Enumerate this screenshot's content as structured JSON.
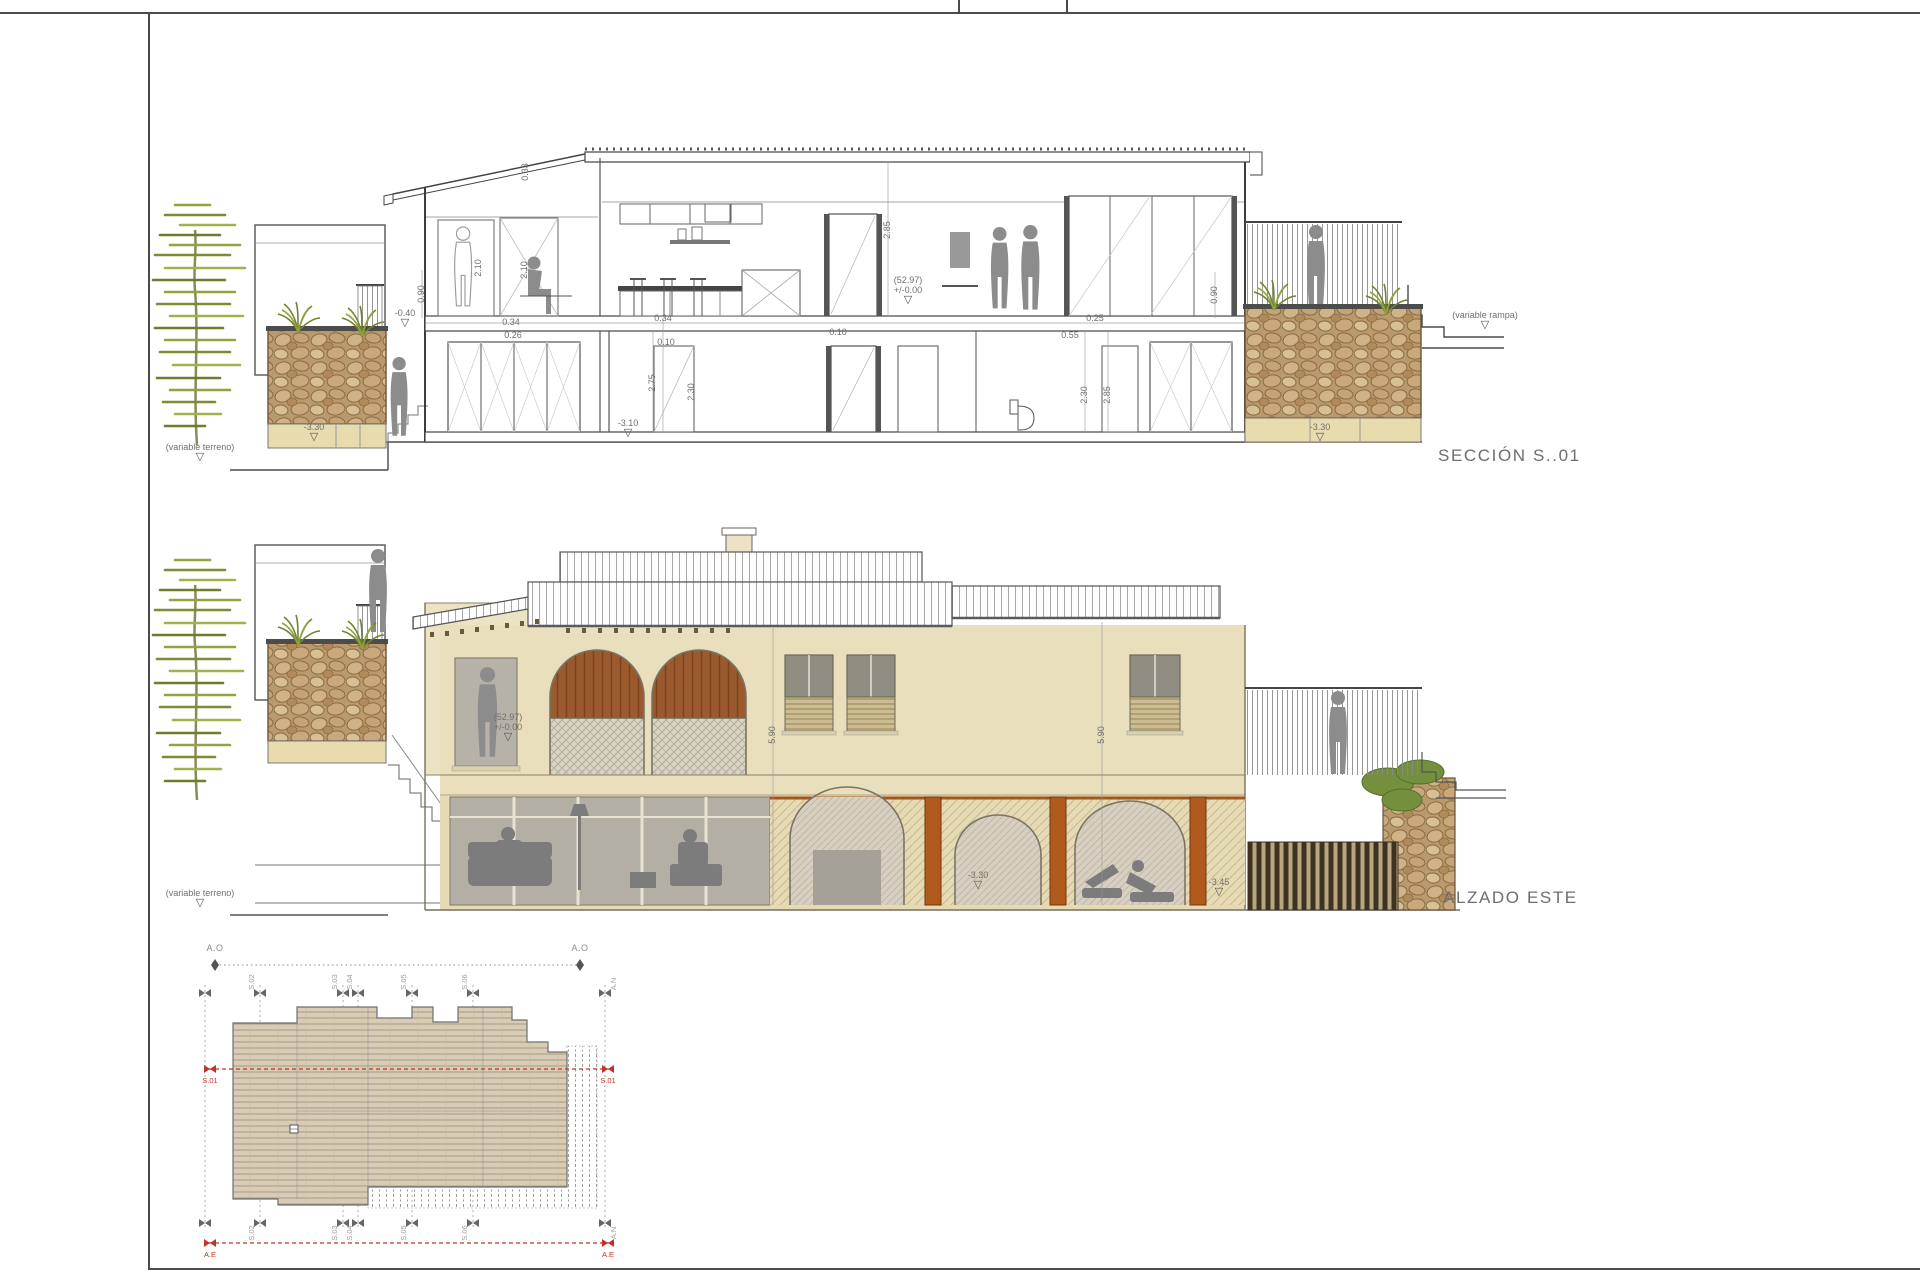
{
  "sheet": {
    "type": "architectural-drawing-sheet",
    "colors": {
      "accent_red": "#c23327",
      "stone": "#b89a6c",
      "wall_beige": "#e9dfbc",
      "wood_orange": "#b05a1e",
      "olive_tree": "#8fa03c",
      "line": "#4a4a4a"
    }
  },
  "section": {
    "title": "SECCIÓN S..01",
    "labels": [
      {
        "type": "level",
        "lines": [
          "-0.40"
        ],
        "x": 275,
        "y": 238,
        "name": "level-minus-0-40"
      },
      {
        "type": "dim",
        "text": "0.34",
        "x": 381,
        "y": 243,
        "name": "dim-0-34"
      },
      {
        "type": "dim",
        "text": "0.26",
        "x": 383,
        "y": 256,
        "name": "dim-0-26"
      },
      {
        "type": "dim",
        "text": "0.34",
        "x": 533,
        "y": 239,
        "name": "dim-0-34"
      },
      {
        "type": "dim",
        "text": "0.10",
        "x": 536,
        "y": 263,
        "name": "dim-0-10"
      },
      {
        "type": "dim",
        "text": "0.10",
        "x": 708,
        "y": 253,
        "name": "dim-0-10"
      },
      {
        "type": "dim",
        "text": "0.25",
        "x": 965,
        "y": 239,
        "name": "dim-0-25"
      },
      {
        "type": "dim",
        "text": "0.55",
        "x": 940,
        "y": 256,
        "name": "dim-0-55"
      },
      {
        "type": "rdim",
        "text": "0.90",
        "x": 292,
        "y": 214,
        "name": "dim-0-90"
      },
      {
        "type": "rdim",
        "text": "2.10",
        "x": 349,
        "y": 188,
        "name": "dim-2-10"
      },
      {
        "type": "rdim",
        "text": "2.10",
        "x": 395,
        "y": 190,
        "name": "dim-2-10"
      },
      {
        "type": "rdim",
        "text": "0.33",
        "x": 396,
        "y": 92,
        "name": "dim-0-33"
      },
      {
        "type": "rdim",
        "text": "2.75",
        "x": 523,
        "y": 303,
        "name": "dim-2-75"
      },
      {
        "type": "rdim",
        "text": "2.30",
        "x": 562,
        "y": 312,
        "name": "dim-2-30"
      },
      {
        "type": "rdim",
        "text": "2.85",
        "x": 758,
        "y": 150,
        "name": "dim-2-85"
      },
      {
        "type": "rdim",
        "text": "2.30",
        "x": 955,
        "y": 315,
        "name": "dim-2-30"
      },
      {
        "type": "rdim",
        "text": "2.85",
        "x": 978,
        "y": 315,
        "name": "dim-2-85"
      },
      {
        "type": "rdim",
        "text": "0.90",
        "x": 1085,
        "y": 215,
        "name": "dim-0-90"
      },
      {
        "type": "level",
        "lines": [
          "-3.30"
        ],
        "x": 184,
        "y": 352,
        "name": "level-minus-3-30"
      },
      {
        "type": "level",
        "lines": [
          "(variable terreno)"
        ],
        "x": 70,
        "y": 372,
        "name": "level-variable-terreno"
      },
      {
        "type": "level",
        "lines": [
          "-3.10"
        ],
        "x": 498,
        "y": 348,
        "name": "level-minus-3-10"
      },
      {
        "type": "level",
        "lines": [
          "(52.97)",
          "+/-0.00"
        ],
        "x": 778,
        "y": 210,
        "name": "level-zero"
      },
      {
        "type": "level",
        "lines": [
          "-3.30"
        ],
        "x": 1190,
        "y": 352,
        "name": "level-minus-3-30"
      },
      {
        "type": "level",
        "lines": [
          "(variable rampa)"
        ],
        "x": 1355,
        "y": 240,
        "name": "level-variable-rampa"
      }
    ]
  },
  "elevation": {
    "title": "ALZADO ESTE",
    "labels": [
      {
        "type": "level",
        "lines": [
          "(52.97)",
          "+/-0.00"
        ],
        "x": 378,
        "y": 207,
        "name": "level-zero"
      },
      {
        "type": "level",
        "lines": [
          "-3.30"
        ],
        "x": 848,
        "y": 360,
        "name": "level-minus-3-30"
      },
      {
        "type": "level",
        "lines": [
          "-3.45"
        ],
        "x": 1089,
        "y": 367,
        "name": "level-minus-3-45"
      },
      {
        "type": "level",
        "lines": [
          "(variable terreno)"
        ],
        "x": 70,
        "y": 378,
        "name": "level-variable-terreno"
      },
      {
        "type": "rdim",
        "text": "5.90",
        "x": 643,
        "y": 215,
        "name": "dim-5-90"
      },
      {
        "type": "rdim",
        "text": "5.90",
        "x": 972,
        "y": 215,
        "name": "dim-5-90"
      }
    ]
  },
  "plan": {
    "labels": [
      {
        "type": "plain",
        "text": "A.O",
        "x": 35,
        "y": 14,
        "name": "elevation-mark-ao"
      },
      {
        "type": "plain",
        "text": "A.O",
        "x": 400,
        "y": 14,
        "name": "elevation-mark-ao"
      },
      {
        "type": "rplan",
        "text": "S.02",
        "x": 72,
        "y": 47,
        "name": "section-mark-s02"
      },
      {
        "type": "rplan",
        "text": "S.03",
        "x": 155,
        "y": 47,
        "name": "section-mark-s03"
      },
      {
        "type": "rplan",
        "text": "S.04",
        "x": 170,
        "y": 47,
        "name": "section-mark-s04"
      },
      {
        "type": "rplan",
        "text": "S.05",
        "x": 224,
        "y": 47,
        "name": "section-mark-s05"
      },
      {
        "type": "rplan",
        "text": "S.06",
        "x": 285,
        "y": 47,
        "name": "section-mark-s06"
      },
      {
        "type": "rplan",
        "text": "A.N",
        "x": 434,
        "y": 49,
        "name": "elevation-mark-an"
      },
      {
        "type": "rplan",
        "text": "S.02",
        "x": 72,
        "y": 298,
        "name": "section-mark-s02"
      },
      {
        "type": "rplan",
        "text": "S.03",
        "x": 155,
        "y": 298,
        "name": "section-mark-s03"
      },
      {
        "type": "rplan",
        "text": "S.04",
        "x": 170,
        "y": 298,
        "name": "section-mark-s04"
      },
      {
        "type": "rplan",
        "text": "S.05",
        "x": 224,
        "y": 298,
        "name": "section-mark-s05"
      },
      {
        "type": "rplan",
        "text": "S.06",
        "x": 285,
        "y": 298,
        "name": "section-mark-s06"
      },
      {
        "type": "rplan",
        "text": "A.N",
        "x": 434,
        "y": 298,
        "name": "elevation-mark-an"
      },
      {
        "type": "red",
        "text": "S.01",
        "x": 30,
        "y": 146,
        "name": "section-line-mark-s01"
      },
      {
        "type": "red",
        "text": "S.01",
        "x": 428,
        "y": 146,
        "name": "section-line-mark-s01"
      },
      {
        "type": "red",
        "text": "A.E",
        "x": 30,
        "y": 320,
        "name": "elevation-line-mark-ae"
      },
      {
        "type": "red",
        "text": "A.E",
        "x": 428,
        "y": 320,
        "name": "elevation-line-mark-ae"
      }
    ]
  }
}
